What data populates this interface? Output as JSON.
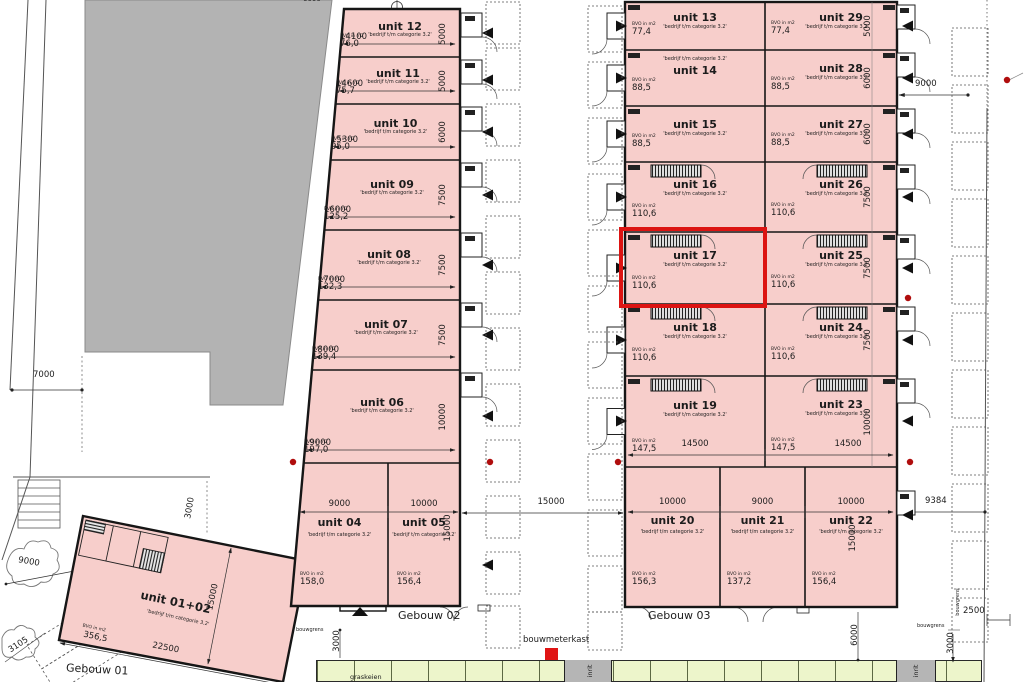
{
  "drawing": {
    "unit_fill_color": "#f7cecb",
    "highlight_color": "#dc1412",
    "gray_building_color": "#b3b3b3",
    "green_strip_color": "#edf5cb",
    "marker_red": "#b00d0d"
  },
  "buildings": {
    "gebouw01": {
      "label": "Gebouw 01",
      "unit": {
        "name": "unit 01+02",
        "category": "'bedrijf t/m categorie 3.2'",
        "bvo_label": "BVO in m2",
        "bvo": "356,5",
        "width": "22500",
        "depth": "15000"
      }
    },
    "gebouw02": {
      "label": "Gebouw 02",
      "units": [
        {
          "name": "unit 12",
          "category": "'bedrijf t/m categorie 3.2'",
          "bvo_label": "BVO in m2",
          "bvo": "76,0",
          "width": "14100",
          "depth": "5000"
        },
        {
          "name": "unit 11",
          "category": "'bedrijf t/m categorie 3.2'",
          "bvo_label": "BVO in m2",
          "bvo": "75,7",
          "width": "14600",
          "depth": "5000"
        },
        {
          "name": "unit 10",
          "category": "'bedrijf t/m categorie 3.2'",
          "bvo_label": "BVO in m2",
          "bvo": "95,0",
          "width": "15300",
          "depth": "6000"
        },
        {
          "name": "unit 09",
          "category": "'bedrijf t/m categorie 3.2'",
          "bvo_label": "BVO in m2",
          "bvo": "125,2",
          "width": "16000",
          "depth": "7500"
        },
        {
          "name": "unit 08",
          "category": "'bedrijf t/m categorie 3.2'",
          "bvo_label": "BVO in m2",
          "bvo": "132,3",
          "width": "17000",
          "depth": "7500"
        },
        {
          "name": "unit 07",
          "category": "'bedrijf t/m categorie 3.2'",
          "bvo_label": "BVO in m2",
          "bvo": "139,4",
          "width": "18000",
          "depth": "7500"
        },
        {
          "name": "unit 06",
          "category": "'bedrijf t/m categorie 3.2'",
          "bvo_label": "BVO in m2",
          "bvo": "197,0",
          "width": "19000",
          "depth": "10000"
        },
        {
          "name": "unit 04",
          "category": "'bedrijf t/m categorie 3.2'",
          "bvo_label": "BVO in m2",
          "bvo": "158,0",
          "width": "9000"
        },
        {
          "name": "unit 05",
          "category": "'bedrijf t/m categorie 3.2'",
          "bvo_label": "BVO in m2",
          "bvo": "156,4",
          "width": "10000",
          "depth": "15000"
        }
      ]
    },
    "gebouw03": {
      "label": "Gebouw 03",
      "left_units": [
        {
          "name": "unit 13",
          "category": "'bedrijf t/m categorie 3.2'",
          "bvo_label": "BVO in m2",
          "bvo": "77,4"
        },
        {
          "name": "unit 14",
          "category": "'bedrijf t/m categorie 3.2'",
          "bvo_label": "BVO in m2",
          "bvo": "88,5",
          "category_first": true
        },
        {
          "name": "unit 15",
          "category": "'bedrijf t/m categorie 3.2'",
          "bvo_label": "BVO in m2",
          "bvo": "88,5"
        },
        {
          "name": "unit 16",
          "category": "'bedrijf t/m categorie 3.2'",
          "bvo_label": "BVO in m2",
          "bvo": "110,6"
        },
        {
          "name": "unit 17",
          "category": "'bedrijf t/m categorie 3.2'",
          "bvo_label": "BVO in m2",
          "bvo": "110,6",
          "highlighted": true
        },
        {
          "name": "unit 18",
          "category": "'bedrijf t/m categorie 3.2'",
          "bvo_label": "BVO in m2",
          "bvo": "110,6"
        },
        {
          "name": "unit 19",
          "category": "'bedrijf t/m categorie 3.2'",
          "bvo_label": "BVO in m2",
          "bvo": "147,5",
          "width": "14500"
        }
      ],
      "right_units": [
        {
          "name": "unit 29",
          "category": "'bedrijf t/m categorie 3.2'",
          "bvo_label": "BVO in m2",
          "bvo": "77,4",
          "depth": "5000"
        },
        {
          "name": "unit 28",
          "category": "'bedrijf t/m categorie 3.2'",
          "bvo_label": "BVO in m2",
          "bvo": "88,5",
          "depth": "6000"
        },
        {
          "name": "unit 27",
          "category": "'bedrijf t/m categorie 3.2'",
          "bvo_label": "BVO in m2",
          "bvo": "88,5",
          "depth": "6000"
        },
        {
          "name": "unit 26",
          "category": "'bedrijf t/m categorie 3.2'",
          "bvo_label": "BVO in m2",
          "bvo": "110,6",
          "depth": "7500"
        },
        {
          "name": "unit 25",
          "category": "'bedrijf t/m categorie 3.2'",
          "bvo_label": "BVO in m2",
          "bvo": "110,6",
          "depth": "7500"
        },
        {
          "name": "unit 24",
          "category": "'bedrijf t/m categorie 3.2'",
          "bvo_label": "BVO in m2",
          "bvo": "110,6",
          "depth": "7500"
        },
        {
          "name": "unit 23",
          "category": "'bedrijf t/m categorie 3.2'",
          "bvo_label": "BVO in m2",
          "bvo": "147,5",
          "width": "14500",
          "depth": "10000"
        }
      ],
      "bottom_units": [
        {
          "name": "unit 20",
          "category": "'bedrijf t/m categorie 3.2'",
          "bvo_label": "BVO in m2",
          "bvo": "156,3",
          "width": "10000"
        },
        {
          "name": "unit 21",
          "category": "'bedrijf t/m categorie 3.2'",
          "bvo_label": "BVO in m2",
          "bvo": "137,2",
          "width": "9000"
        },
        {
          "name": "unit 22",
          "category": "'bedrijf t/m categorie 3.2'",
          "bvo_label": "BVO in m2",
          "bvo": "156,4",
          "width": "10000",
          "depth": "15000"
        }
      ]
    }
  },
  "site": {
    "bouwmeterkast": "bouwmeterkast",
    "graskeien": "graskeien",
    "inrit": "inrit",
    "bouwgrens": "bouwgrens",
    "dims": {
      "top_6000": "6000",
      "left_7000": "7000",
      "left_3000": "3000",
      "left_9000": "9000",
      "left_3105": "3105",
      "mid_15000": "15000",
      "right_9000": "9000",
      "right_9384": "9384",
      "right_2500": "2500",
      "right_3000": "3000",
      "bottom_6000": "6000",
      "bottom_3000": "3000"
    }
  }
}
